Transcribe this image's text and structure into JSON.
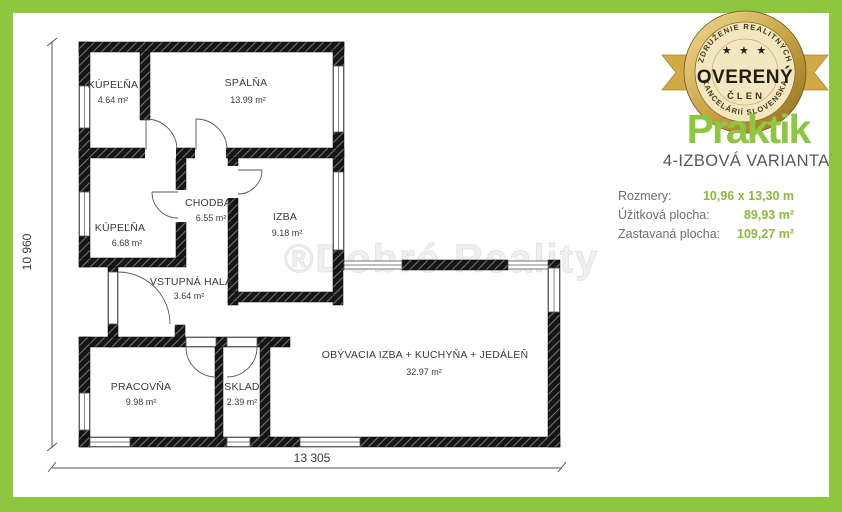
{
  "plan": {
    "rooms": [
      {
        "name": "KÚPEĽŇA",
        "area": "4.64 m²"
      },
      {
        "name": "SPÁLŇA",
        "area": "13.99 m²"
      },
      {
        "name": "KÚPEĽŇA",
        "area": "6.68 m²"
      },
      {
        "name": "CHODBA",
        "area": "6.55 m²"
      },
      {
        "name": "IZBA",
        "area": "9.18 m²"
      },
      {
        "name": "VSTUPNÁ HALA",
        "area": "3.64 m²"
      },
      {
        "name": "PRACOVŇA",
        "area": "9.98 m²"
      },
      {
        "name": "SKLAD",
        "area": "2.39 m²"
      },
      {
        "name": "OBÝVACIA IZBA + KUCHYŇA + JEDÁLEŇ",
        "area": "32.97 m²"
      }
    ],
    "dimensions": {
      "height": "10 960",
      "width": "13 305"
    },
    "watermark": "®Dobré Reality"
  },
  "badge": {
    "arc_top": "ZDRUŽENIE REALITNÝCH",
    "arc_bottom": "KANCELÁRIÍ SLOVENSKA",
    "stars": "★ ★ ★",
    "title": "OVERENÝ",
    "subtitle": "ČLEN"
  },
  "logo": {
    "text": "Praktik"
  },
  "variant": {
    "label": "4-IZBOVÁ VARIANTA",
    "mark": "*"
  },
  "info": {
    "rows": [
      {
        "label": "Rozmery:",
        "value": "10,96 x 13,30 m"
      },
      {
        "label": "Úžitková plocha:",
        "value": "89,93 m²"
      },
      {
        "label": "Zastavaná plocha:",
        "value": "109,27 m²"
      }
    ]
  },
  "colors": {
    "accent_green": "#8dc63f",
    "badge_gold": "#d2aa45",
    "label_gray": "#6d6e71",
    "value_green": "#8cb83c"
  }
}
